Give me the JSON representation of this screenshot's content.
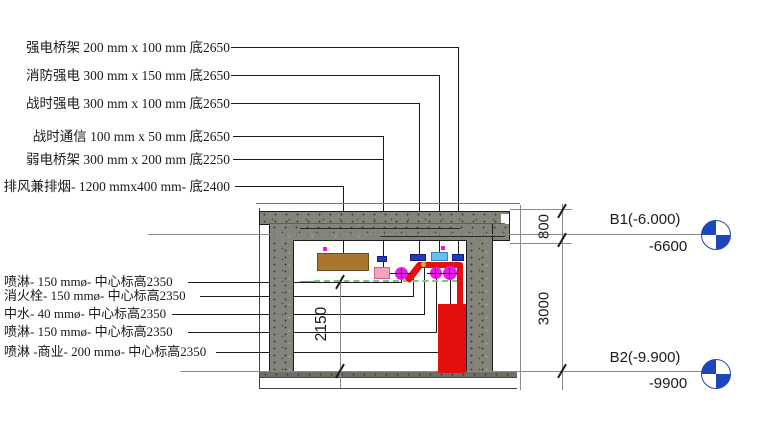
{
  "drawing": {
    "title_context": "building-section-mep-annotations",
    "annotations_top": [
      {
        "text": "强电桥架 200 mm x 100 mm 底2650"
      },
      {
        "text": "消防强电 300 mm x 150 mm 底2650"
      },
      {
        "text": "战时强电 300 mm x 100 mm 底2650"
      },
      {
        "text": "战时通信 100 mm x 50 mm 底2650"
      },
      {
        "text": "弱电桥架 300 mm x 200 mm 底2250"
      },
      {
        "text": "排风兼排烟- 1200 mmx400 mm- 底2400"
      }
    ],
    "annotations_left": [
      {
        "text": "喷淋- 150 mmø- 中心标高2350"
      },
      {
        "text": "消火栓- 150 mmø- 中心标高2350"
      },
      {
        "text": "中水- 40 mmø- 中心标高2350"
      },
      {
        "text": "喷淋- 150 mmø- 中心标高2350"
      },
      {
        "text": "喷淋 -商业- 200 mmø- 中心标高2350"
      }
    ],
    "levels": [
      {
        "name": "B1(-6.000)",
        "elevation_mm": "-6600"
      },
      {
        "name": "B2(-9.900)",
        "elevation_mm": "-9900"
      }
    ],
    "dimensions": [
      {
        "value": "800"
      },
      {
        "value": "3000"
      },
      {
        "value": "2150"
      }
    ],
    "colors": {
      "level_marker_blue": "#1d46bd",
      "cable_tray_blue": "#2438c8",
      "fire_tray_cyan": "#62c2e9",
      "weak_tray_pink": "#f2a3bd",
      "duct_brown": "#a6772c",
      "pipe_magenta": "#e61ce6",
      "hydrant_red": "#e60f0f",
      "centerline_green": "#7cc57f",
      "reclaimed_water_dot": "#a5bf3f",
      "concrete_gray": "#85847b"
    }
  }
}
